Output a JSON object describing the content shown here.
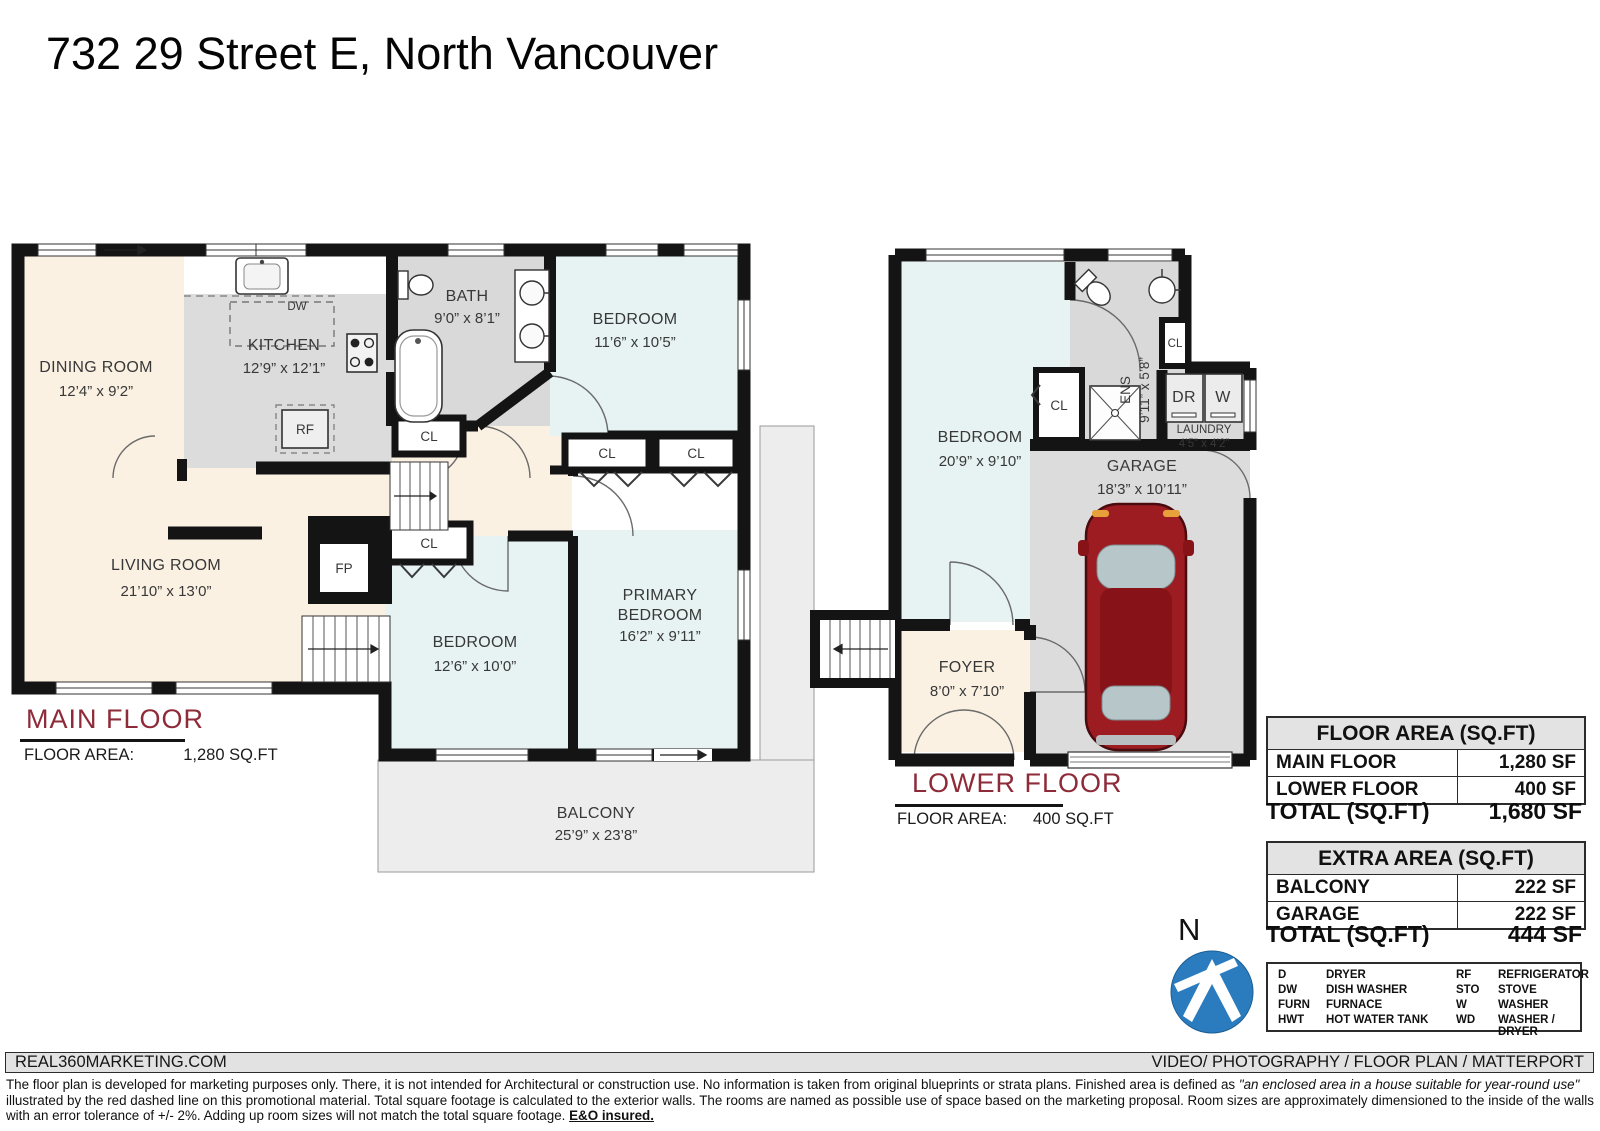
{
  "title": "732 29 Street E, North Vancouver",
  "colors": {
    "accent_red": "#8e2b39",
    "wall": "#141414",
    "room_cream": "#fbf1e3",
    "room_blue": "#e7f3f3",
    "room_gray": "#d9d9d9",
    "balcony_gray": "#ededed",
    "north_blue": "#2b7cbf"
  },
  "labels": {
    "cl": "CL",
    "fp": "FP",
    "dw": "DW",
    "rf": "RF",
    "dr": "DR",
    "w": "W",
    "north": "N"
  },
  "main_floor": {
    "name": "MAIN FLOOR",
    "floor_area_label": "FLOOR AREA:",
    "floor_area_value": "1,280 SQ.FT",
    "rooms": {
      "dining": {
        "name": "DINING ROOM",
        "dims": "12’4” x 9’2”"
      },
      "kitchen": {
        "name": "KITCHEN",
        "dims": "12’9” x 12’1”"
      },
      "bath": {
        "name": "BATH",
        "dims": "9’0” x 8’1”"
      },
      "bedroom_top": {
        "name": "BEDROOM",
        "dims": "11’6” x 10’5”"
      },
      "living": {
        "name": "LIVING ROOM",
        "dims": "21’10” x 13’0”"
      },
      "bedroom_left": {
        "name": "BEDROOM",
        "dims": "12’6” x 10’0”"
      },
      "primary": {
        "line1": "PRIMARY",
        "line2": "BEDROOM",
        "dims": "16’2” x 9’11”"
      },
      "balcony": {
        "name": "BALCONY",
        "dims": "25’9” x 23’8”"
      }
    }
  },
  "lower_floor": {
    "name": "LOWER FLOOR",
    "floor_area_label": "FLOOR AREA:",
    "floor_area_value": "400 SQ.FT",
    "rooms": {
      "bedroom": {
        "name": "BEDROOM",
        "dims": "20’9” x 9’10”"
      },
      "ens": {
        "name": "ENS",
        "dims": "9’11” x 5’8”"
      },
      "laundry": {
        "name": "LAUNDRY",
        "dims": "4’5” x 4’2”"
      },
      "garage": {
        "name": "GARAGE",
        "dims": "18’3” x 10’11”"
      },
      "foyer": {
        "name": "FOYER",
        "dims": "8’0” x 7’10”"
      }
    }
  },
  "tables": {
    "floor_area": {
      "header": "FLOOR AREA (SQ.FT)",
      "rows": [
        {
          "label": "MAIN FLOOR",
          "value": "1,280 SF"
        },
        {
          "label": "LOWER FLOOR",
          "value": "400 SF"
        }
      ],
      "total_label": "TOTAL (SQ.FT)",
      "total_value": "1,680 SF"
    },
    "extra_area": {
      "header": "EXTRA AREA (SQ.FT)",
      "rows": [
        {
          "label": "BALCONY",
          "value": "222 SF"
        },
        {
          "label": "GARAGE",
          "value": "222 SF"
        }
      ],
      "total_label": "TOTAL (SQ.FT)",
      "total_value": "444 SF"
    }
  },
  "legend": {
    "rows": [
      {
        "a": "D",
        "ad": "DRYER",
        "b": "RF",
        "bd": "REFRIGERATOR"
      },
      {
        "a": "DW",
        "ad": "DISH WASHER",
        "b": "STO",
        "bd": "STOVE"
      },
      {
        "a": "FURN",
        "ad": "FURNACE",
        "b": "W",
        "bd": "WASHER"
      },
      {
        "a": "HWT",
        "ad": "HOT WATER TANK",
        "b": "WD",
        "bd": "WASHER / DRYER"
      }
    ]
  },
  "footer": {
    "brand": "REAL360MARKETING.COM",
    "services": "VIDEO/ PHOTOGRAPHY / FLOOR PLAN / MATTERPORT",
    "disclaimer_p1": "The floor plan is developed for marketing purposes only. There, it is not intended for Architectural or construction use. No information is  taken from original blueprints or strata plans. Finished area is defined as  ",
    "disclaimer_italic": "\"an enclosed area in a house suitable for year-round use\"",
    "disclaimer_p2": " illustrated by the red dashed line on this promotional material. Total square footage is calculated to the exterior walls. The rooms are named as possible use of space based on the marketing proposal. Room sizes are approximately dimensioned to the inside of the walls with an error tolerance of +/- 2%. Adding up room sizes will not match the total square footage. ",
    "disclaimer_bold": "E&O insured."
  }
}
